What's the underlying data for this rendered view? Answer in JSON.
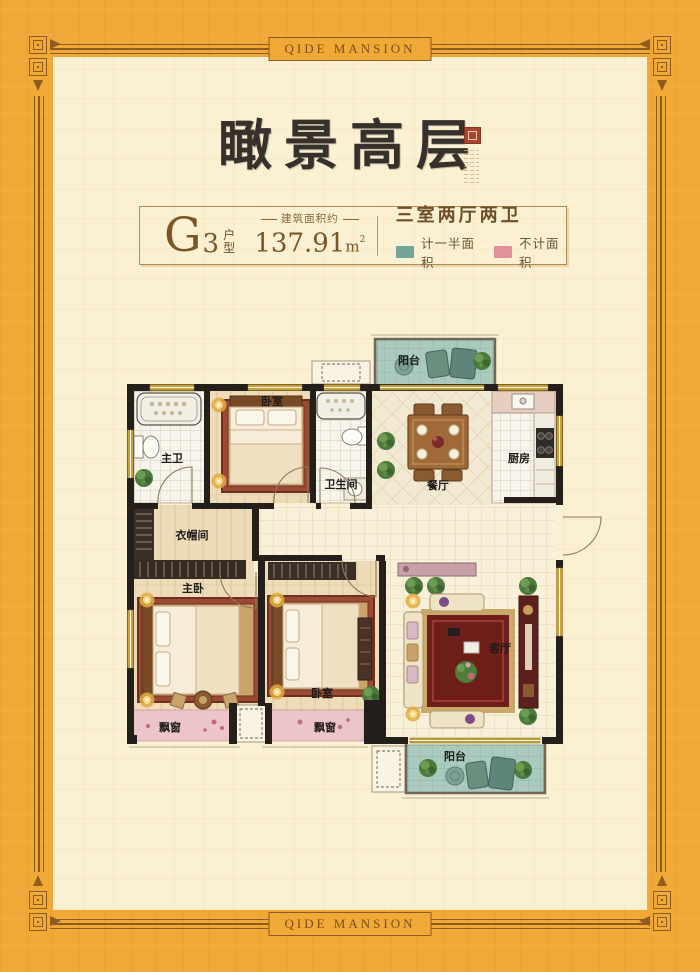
{
  "brand": {
    "top": "QIDE MANSION",
    "bottom": "QIDE MANSION"
  },
  "title": "瞰景高层",
  "info": {
    "unit_letter": "G",
    "unit_number": "3",
    "unit_word_top": "户",
    "unit_word_bottom": "型",
    "area_caption": "建筑面积约",
    "area_value": "137.91",
    "area_unit": "m",
    "area_sup": "2",
    "rooms_summary": "三室两厅两卫",
    "legend": [
      {
        "label": "计一半面积",
        "color": "#73a699"
      },
      {
        "label": "不计面积",
        "color": "#e2909a"
      }
    ]
  },
  "plan": {
    "labels": {
      "balcony_top": "阳台",
      "master_bath": "主卫",
      "bedroom_top": "卧室",
      "bathroom": "卫生间",
      "dining": "餐厅",
      "kitchen": "厨房",
      "cloakroom": "衣帽间",
      "master_bedroom": "主卧",
      "bedroom_second": "卧室",
      "living": "客厅",
      "bay_left": "飘窗",
      "bay_right": "飘窗",
      "balcony_bottom": "阳台"
    }
  },
  "colors": {
    "page_bg": "#f0a837",
    "frame_line": "#8d5c20",
    "inner_bg": "#fbf0d2",
    "half_area_teal": "#73a699",
    "no_area_pink": "#e2909a",
    "wall": "#241f1b"
  }
}
